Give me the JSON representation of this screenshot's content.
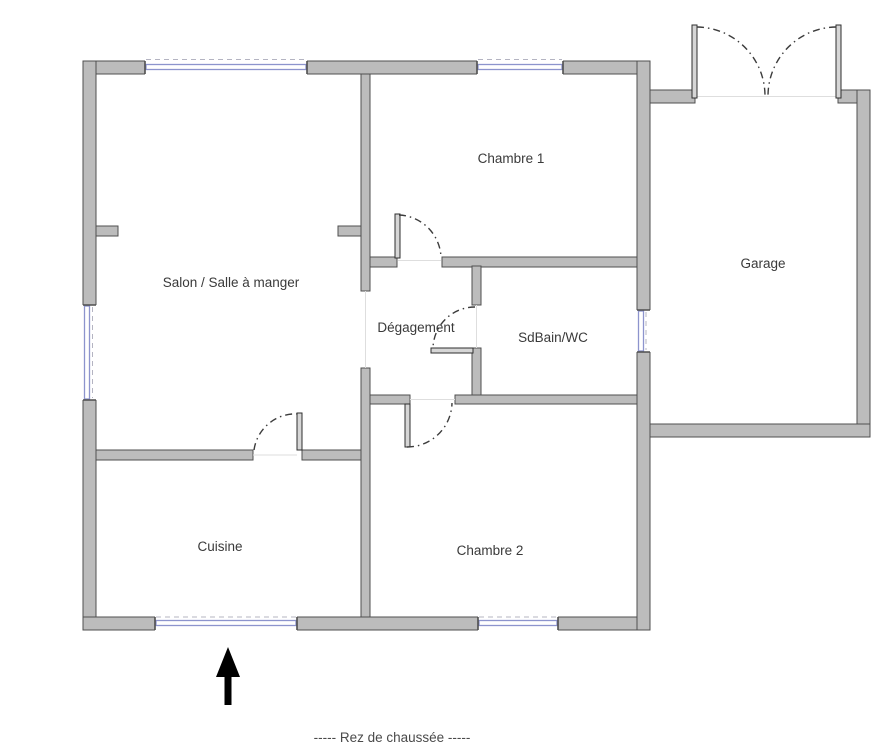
{
  "floorplan": {
    "caption": "-----  Rez de chaussée  -----",
    "rooms": [
      {
        "label": "Salon / Salle à manger"
      },
      {
        "label": "Chambre 1"
      },
      {
        "label": "Garage"
      },
      {
        "label": "Dégagement"
      },
      {
        "label": "SdBain/WC"
      },
      {
        "label": "Cuisine"
      },
      {
        "label": "Chambre 2"
      }
    ],
    "icons": {
      "north_arrow": "up-arrow"
    },
    "colors": {
      "wall_fill": "#bcbcbc",
      "wall_outline": "#4f4f4f",
      "window_glass": "#8d94cd",
      "door_arc": "#3c3c3c",
      "label_text": "#3a3a3a",
      "north_arrow": "#000000",
      "background": "#ffffff"
    }
  }
}
